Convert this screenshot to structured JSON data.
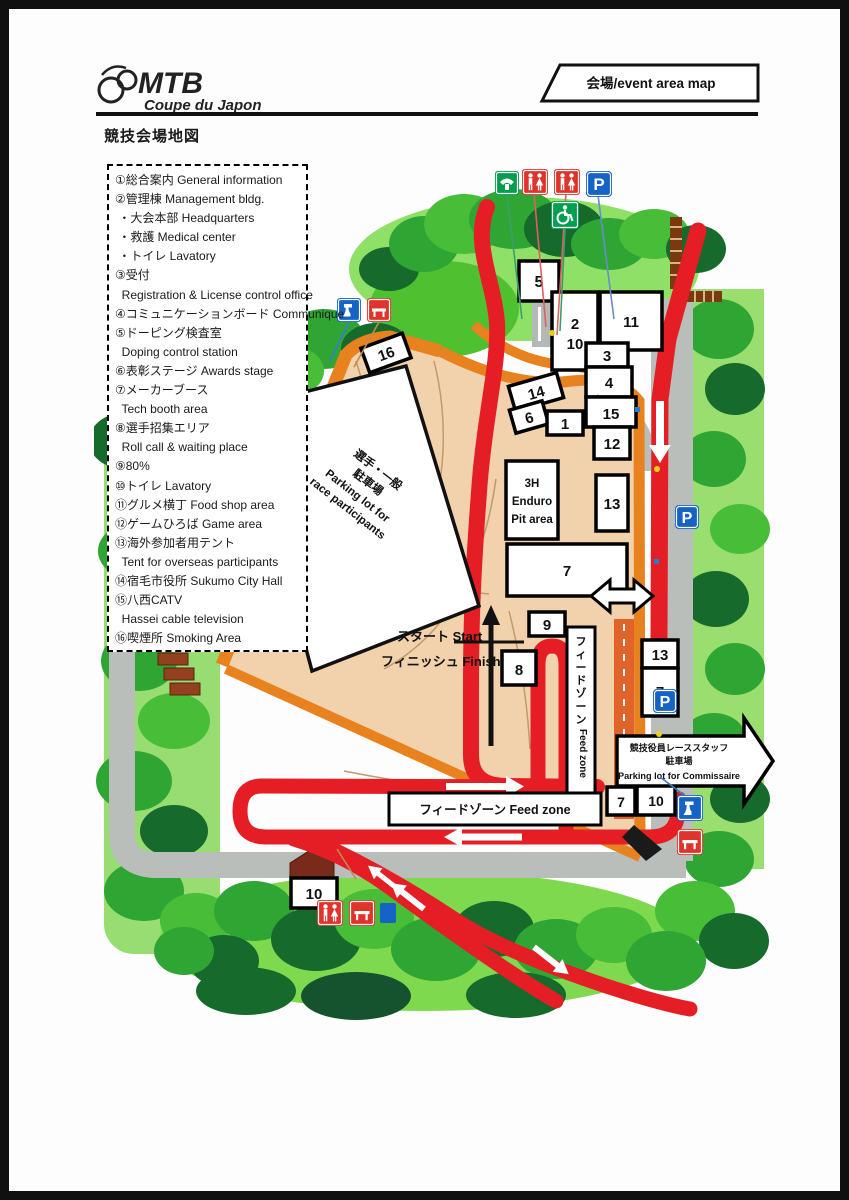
{
  "header": {
    "logo_main": "MTB",
    "logo_sub": "Coupe du Japon",
    "tab_label": "会場/event area map"
  },
  "page_title": "競技会場地図",
  "legend": {
    "items": [
      {
        "text": "①総合案内 General information"
      },
      {
        "text": "②管理棟 Management bldg."
      },
      {
        "text": " ・大会本部 Headquarters"
      },
      {
        "text": " ・救護 Medical center"
      },
      {
        "text": " ・トイレ Lavatory"
      },
      {
        "text": "③受付"
      },
      {
        "text": "  Registration & License control office"
      },
      {
        "text": "④コミュニケーションボード Communique"
      },
      {
        "text": "⑤ドーピング検査室"
      },
      {
        "text": "  Doping control station"
      },
      {
        "text": "⑥表彰ステージ Awards stage"
      },
      {
        "text": "⑦メーカーブース"
      },
      {
        "text": "  Tech booth area"
      },
      {
        "text": "⑧選手招集エリア"
      },
      {
        "text": "  Roll call & waiting place"
      },
      {
        "text": "⑨80%"
      },
      {
        "text": "⑩トイレ Lavatory"
      },
      {
        "text": "⑪グルメ横丁 Food shop area"
      },
      {
        "text": "⑫ゲームひろば Game area"
      },
      {
        "text": "⑬海外参加者用テント"
      },
      {
        "text": "  Tent for overseas participants"
      },
      {
        "text": "⑭宿毛市役所 Sukumo City Hall"
      },
      {
        "text": "⑮八西CATV"
      },
      {
        "text": "  Hassei cable television"
      },
      {
        "text": "⑯喫煙所 Smoking Area"
      }
    ]
  },
  "map": {
    "markers": {
      "b5": "5",
      "b2": "2",
      "b10": "10",
      "b11": "11",
      "b3": "3",
      "b4": "4",
      "b15": "15",
      "b14": "14",
      "b6": "6",
      "b1": "1",
      "b12": "12",
      "b13": "13",
      "b7": "7",
      "b9": "9",
      "b8": "8",
      "b13b": "13",
      "b7b": "7",
      "b7c": "7",
      "b10b": "10",
      "b10c": "10",
      "b16": "16"
    },
    "labels": {
      "start": "スタート Start",
      "finish": "フィニッシュ Finish",
      "feed_zone_h": "フィードゾーン Feed zone",
      "fzv_chars": [
        "フ",
        "ィ",
        "ー",
        "ド",
        "ゾ",
        "ー",
        "ン"
      ],
      "fzv_en": "Feed zone",
      "pit": [
        "3H",
        "Enduro",
        "Pit area"
      ],
      "parking_participants": [
        "選手・一般",
        "駐車場",
        "Parking lot for",
        "race participants"
      ],
      "commissaire": [
        "競技役員レーススタッフ",
        "駐車場",
        "Parking lot for Commissaire"
      ],
      "parking_letter": "P"
    },
    "icons": {
      "telephone": "telephone-sign",
      "restroom": "restroom-sign",
      "parking": "parking-P-sign",
      "wheelchair": "accessible-sign",
      "water": "drinking-water-sign",
      "bench": "rest-bench-sign"
    },
    "colors": {
      "course_red": "#e51e25",
      "path_orange": "#e8821e",
      "ground_tan": "#f2d2ac",
      "road_gray": "#babebb",
      "tree_mid": "#2fa534",
      "tree_light": "#7fd94e",
      "tree_dark": "#156a2c",
      "grass": "#8ee066",
      "sign_blue": "#1663c7",
      "sign_green": "#009e4e",
      "sign_red": "#df342b"
    }
  }
}
